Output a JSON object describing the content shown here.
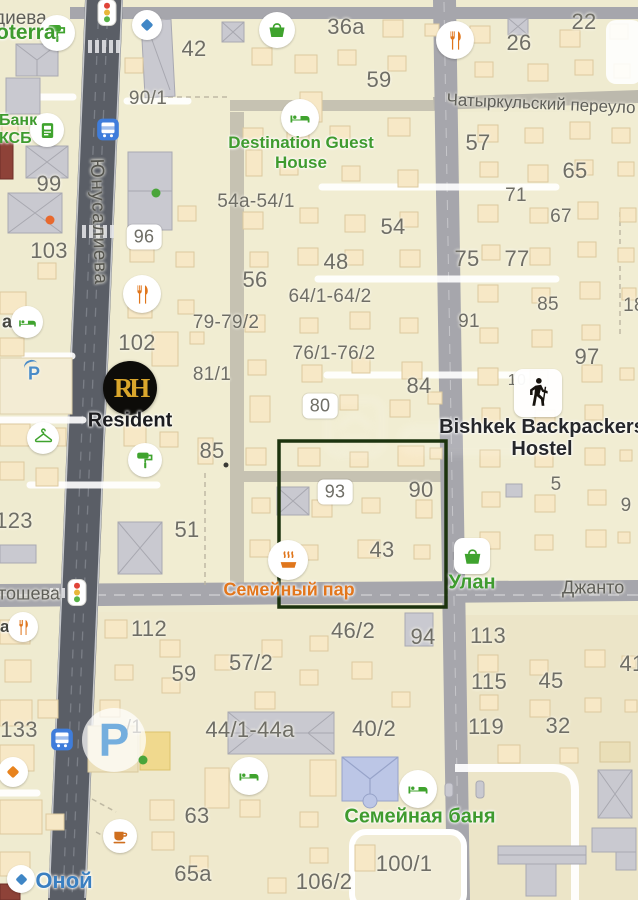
{
  "streets": {
    "yunusalieva": "Юнусалиева",
    "chatyrkulsky_pereulok": "Чатыркульский переуло",
    "dieva_partial": "диева",
    "tosheva_partial": "тошева",
    "dzhantoshev_partial": "Джанто"
  },
  "pois": {
    "oterra_partial": "oterra",
    "bank_line1": "Банк",
    "bank_line2": "КСБ",
    "destination_line1": "Destination Guest",
    "destination_line2": "House",
    "resident_label": "Resident",
    "resident_monogram": "RH",
    "hostel_line1": "Bishkek Backpackers",
    "hostel_line2": "Hostel",
    "semeyny_par": "Семейный пар",
    "ulan": "Улан",
    "semeynaya_banya": "Семейная баня",
    "onoy": "Оной",
    "parking_big": "P",
    "parking_small": "P",
    "partial_a_hotel": "а",
    "partial_a_cafe": "а"
  },
  "house_numbers": [
    "42",
    "36a",
    "59",
    "22",
    "26",
    "90/1",
    "57",
    "65",
    "71",
    "67",
    "54a-54/1",
    "54",
    "56",
    "48",
    "64/1-64/2",
    "75",
    "77",
    "99",
    "103",
    "96",
    "102",
    "79-79/2",
    "76/1-76/2",
    "84",
    "80",
    "81/1",
    "85",
    "85",
    "18",
    "91",
    "97",
    "10",
    "5",
    "9",
    "123",
    "51",
    "93",
    "90",
    "43",
    "112",
    "59",
    "57/2",
    "46/2",
    "94",
    "113",
    "115",
    "45",
    "41",
    "119",
    "32",
    "133",
    "/1",
    "44/1-44a",
    "40/2",
    "63",
    "65a",
    "100/1",
    "106/2"
  ],
  "colors": {
    "poi_green": "#3f9b2f",
    "poi_orange": "#e2761c",
    "poi_blue": "#3f86c6",
    "road_dark": "#5a5e66",
    "road_light": "#a6a6ac",
    "map_background": "#efebd0",
    "building_fill": "#f7e8c6",
    "selection_outline": "#1c330e",
    "resident_gold": "#d9a62c"
  }
}
